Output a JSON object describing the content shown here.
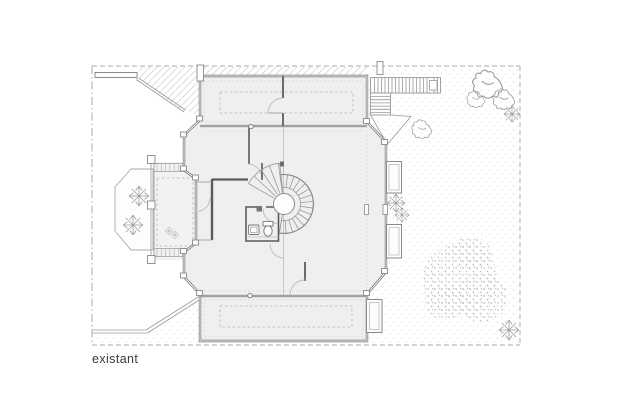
{
  "plan": {
    "label": "existant"
  },
  "colors": {
    "background": "#ffffff",
    "wall": "#6b6b6b",
    "wall-dark": "#5a5a5a",
    "line": "#9a9a9a",
    "line-light": "#bcbcbc",
    "dash": "#b4b4b4",
    "boundary": "#ababab",
    "floor": "#efefee",
    "deck": "#f2f2f1",
    "foliage": "#9a9a9a",
    "text": "#3a3a3a"
  }
}
